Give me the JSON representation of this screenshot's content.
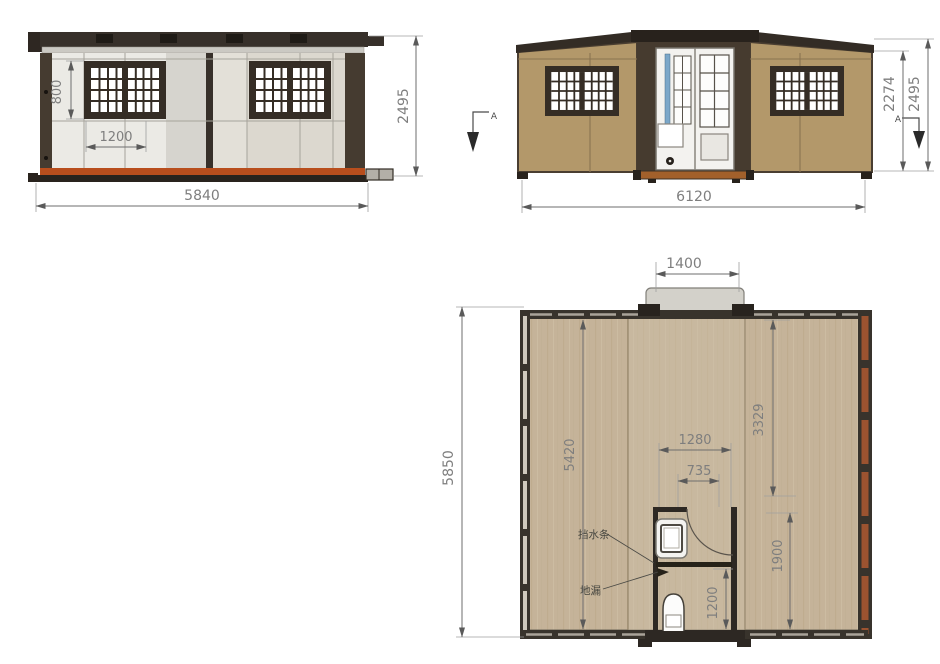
{
  "drawing_title": "expandable container house three-view technical drawing",
  "colors": {
    "frame_dark": "#37302a",
    "wall_light": "#ebeae5",
    "wall_tan": "#b3986a",
    "base_orange": "#b84e1d",
    "deck_orange": "#a2602b",
    "plan_floor": "#c5b399",
    "rust_wall": "#9c5330",
    "porch_gray": "#d3d1ca",
    "accent_blue": "#7ba7c9",
    "dim_gray": "#7e7e7e"
  },
  "front_elevation": {
    "dim_window_height": "800",
    "dim_window_width": "1200",
    "dim_overall_width": "5840",
    "dim_overall_height": "2495"
  },
  "side_elevation": {
    "dim_overall_width": "6120",
    "dim_wall_height": "2274",
    "dim_overall_height": "2495",
    "section_marker_left": "A",
    "section_marker_right": "A"
  },
  "floor_plan": {
    "dim_entry_width": "1400",
    "dim_overall_depth": "5850",
    "dim_left_room_depth": "5420",
    "dim_right_room_depth": "3329",
    "dim_bathroom_width": "1280",
    "dim_bathroom_inner_width": "735",
    "dim_bathroom_depth": "1900",
    "dim_bathroom_lower_depth": "1200",
    "label_water_barrier": "挡水条",
    "label_floor_drain": "地漏"
  }
}
